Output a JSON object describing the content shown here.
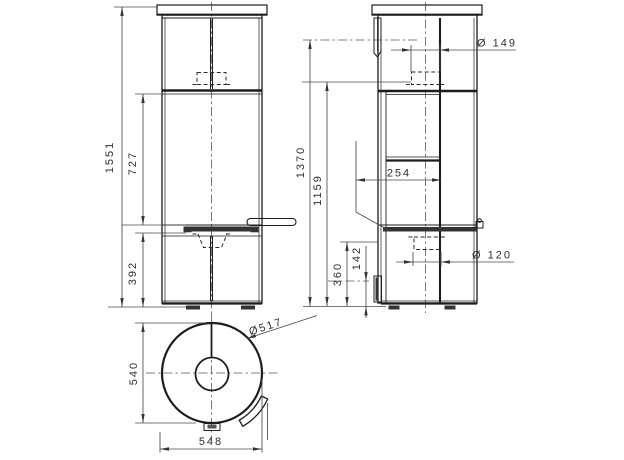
{
  "drawing": {
    "front": {
      "overall_height": "1551",
      "mid_height": "727",
      "base_height": "392"
    },
    "side": {
      "flue_center_height": "1370",
      "flue_bottom_height": "1159",
      "compartment_depth": "254",
      "flue_diameter": "Ø 149",
      "rear_outlet_diameter": "Ø 120",
      "rear_outlet_offset": "142",
      "rear_outlet_center_height": "360"
    },
    "top": {
      "depth": "540",
      "overall_width": "548",
      "body_diameter": "Ø517"
    }
  }
}
